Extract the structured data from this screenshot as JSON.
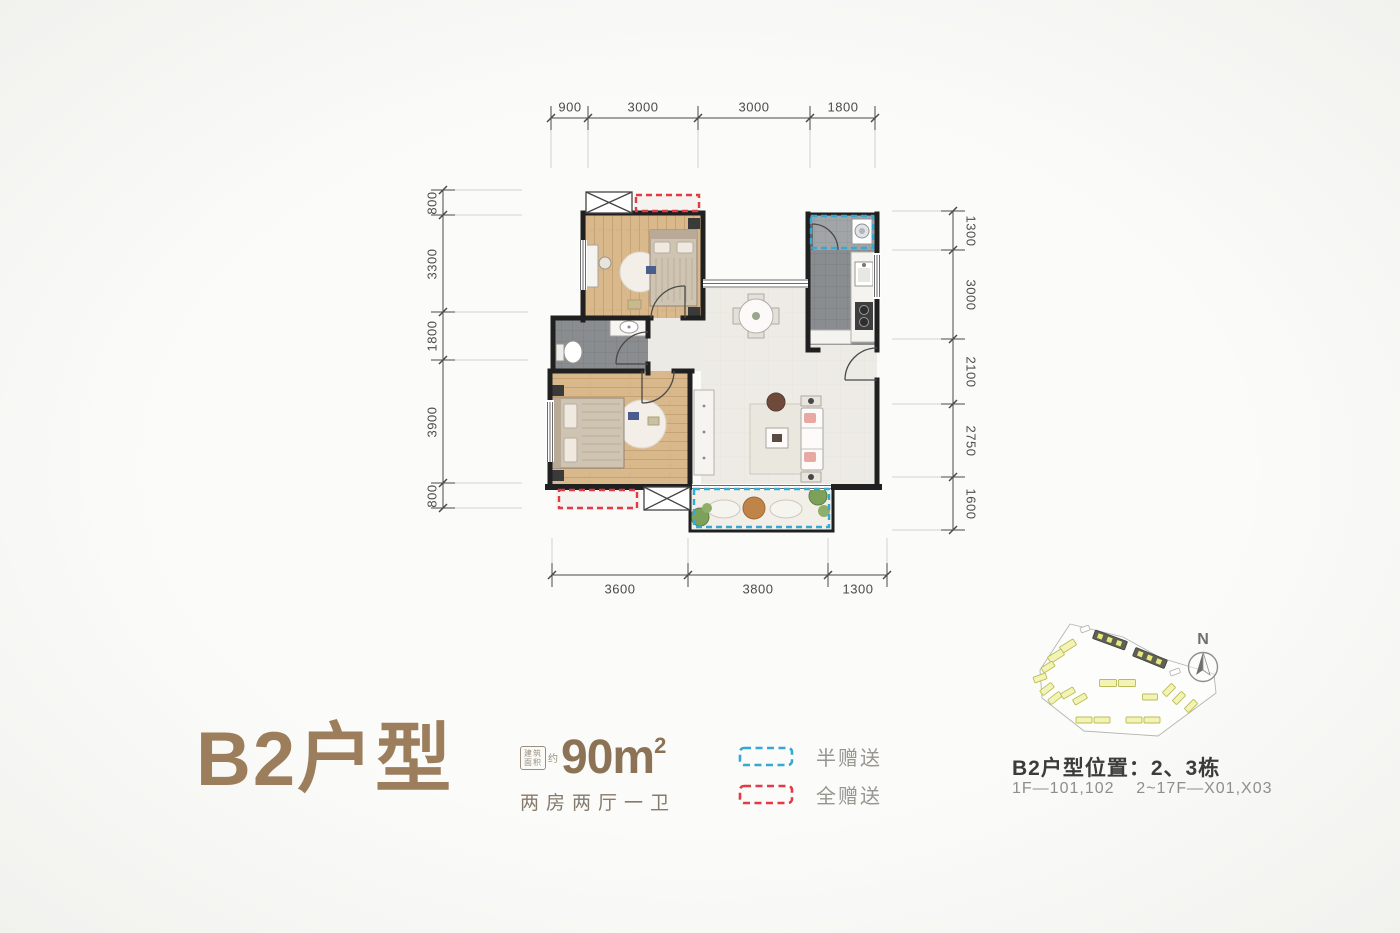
{
  "plan": {
    "title": "B2户型",
    "area_box": {
      "line1": "建筑",
      "line2": "面积",
      "approx": "约"
    },
    "area_value": "90m",
    "area_sup": "2",
    "layout": "两房两厅一卫"
  },
  "legend": {
    "half": {
      "label": "半赠送",
      "color": "#35a9d3"
    },
    "full": {
      "label": "全赠送",
      "color": "#e23b46"
    }
  },
  "location": {
    "title": "B2户型位置：2、3栋",
    "detail": "1F—101,102    2~17F—X01,X03",
    "compass_n": "N"
  },
  "dimensions": {
    "top": [
      "900",
      "3000",
      "3000",
      "1800"
    ],
    "left": [
      "800",
      "3300",
      "1800",
      "3900",
      "800"
    ],
    "right": [
      "1300",
      "3000",
      "2100",
      "2750",
      "1600"
    ],
    "bottom": [
      "3600",
      "3800",
      "1300"
    ]
  },
  "colors": {
    "title_brown": "#9c7e5c",
    "half_gift_blue": "#35a9d3",
    "full_gift_red": "#e23b46",
    "wall_black": "#202020"
  }
}
